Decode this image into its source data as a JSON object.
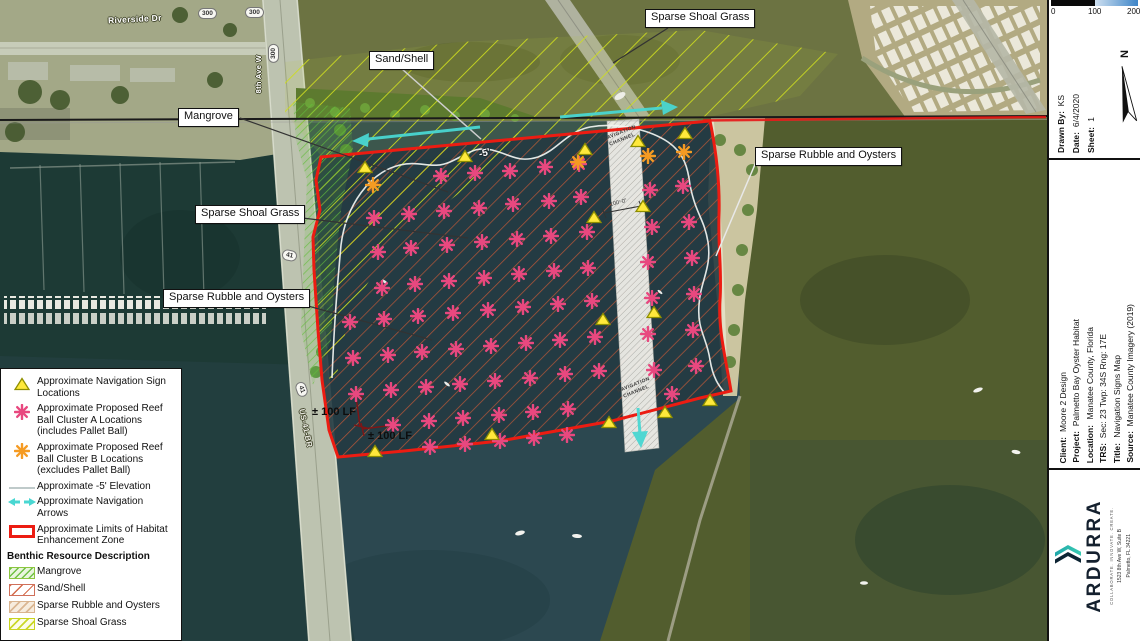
{
  "map": {
    "colors": {
      "zone_outline": "#ec1c12",
      "navigation_arrows": "#49d7d2",
      "cluster_a": "#e8487f",
      "cluster_b": "#f59b23",
      "nav_sign": "#ffe93b"
    },
    "street_labels": {
      "riverside": "Riverside Dr",
      "route300": "300",
      "ave8": "8th Ave W",
      "route41": "41",
      "us41br": "US-41-BR"
    },
    "callouts": {
      "shoal_top": "Sparse Shoal Grass",
      "sand_shell": "Sand/Shell",
      "mangrove": "Mangrove",
      "shoal_left": "Sparse Shoal Grass",
      "rubble_left": "Sparse Rubble and Oysters",
      "rubble_right": "Sparse Rubble and Oysters"
    },
    "channel_label": "NAVIGATION CHANNEL",
    "channel_width_label": "100'-0\"",
    "elevation_label": "-5'",
    "dim_labels": [
      "± 100 LF",
      "± 100 LF"
    ],
    "markers": {
      "cluster_a_color": "#e8487f",
      "cluster_b_color": "#f59b23",
      "sign_color": "#ffe93b",
      "cluster_a": [
        [
          441,
          176
        ],
        [
          475,
          173
        ],
        [
          510,
          171
        ],
        [
          545,
          167
        ],
        [
          579,
          164
        ],
        [
          374,
          218
        ],
        [
          409,
          214
        ],
        [
          444,
          211
        ],
        [
          479,
          208
        ],
        [
          513,
          204
        ],
        [
          549,
          201
        ],
        [
          581,
          197
        ],
        [
          378,
          252
        ],
        [
          411,
          248
        ],
        [
          447,
          245
        ],
        [
          482,
          242
        ],
        [
          517,
          239
        ],
        [
          551,
          236
        ],
        [
          587,
          232
        ],
        [
          382,
          288
        ],
        [
          415,
          284
        ],
        [
          449,
          281
        ],
        [
          484,
          278
        ],
        [
          519,
          274
        ],
        [
          554,
          271
        ],
        [
          588,
          268
        ],
        [
          350,
          322
        ],
        [
          384,
          319
        ],
        [
          418,
          316
        ],
        [
          453,
          313
        ],
        [
          488,
          310
        ],
        [
          523,
          307
        ],
        [
          558,
          304
        ],
        [
          592,
          301
        ],
        [
          353,
          358
        ],
        [
          388,
          355
        ],
        [
          422,
          352
        ],
        [
          456,
          349
        ],
        [
          491,
          346
        ],
        [
          526,
          343
        ],
        [
          560,
          340
        ],
        [
          595,
          337
        ],
        [
          356,
          394
        ],
        [
          391,
          390
        ],
        [
          426,
          387
        ],
        [
          460,
          384
        ],
        [
          495,
          381
        ],
        [
          530,
          378
        ],
        [
          565,
          374
        ],
        [
          599,
          371
        ],
        [
          393,
          425
        ],
        [
          429,
          421
        ],
        [
          463,
          418
        ],
        [
          499,
          415
        ],
        [
          533,
          412
        ],
        [
          568,
          409
        ],
        [
          430,
          447
        ],
        [
          465,
          444
        ],
        [
          500,
          441
        ],
        [
          534,
          438
        ],
        [
          567,
          435
        ],
        [
          650,
          190
        ],
        [
          683,
          186
        ],
        [
          652,
          227
        ],
        [
          689,
          222
        ],
        [
          648,
          262
        ],
        [
          692,
          258
        ],
        [
          652,
          298
        ],
        [
          694,
          294
        ],
        [
          648,
          334
        ],
        [
          693,
          330
        ],
        [
          654,
          370
        ],
        [
          696,
          366
        ],
        [
          672,
          394
        ]
      ],
      "cluster_b": [
        [
          373,
          185
        ],
        [
          578,
          162
        ],
        [
          648,
          156
        ],
        [
          684,
          152
        ]
      ],
      "signs": [
        [
          365,
          168
        ],
        [
          465,
          157
        ],
        [
          585,
          150
        ],
        [
          638,
          142
        ],
        [
          685,
          134
        ],
        [
          594,
          218
        ],
        [
          643,
          207
        ],
        [
          603,
          320
        ],
        [
          654,
          313
        ],
        [
          375,
          452
        ],
        [
          492,
          435
        ],
        [
          609,
          423
        ],
        [
          665,
          413
        ],
        [
          710,
          401
        ]
      ]
    }
  },
  "legend": {
    "items": [
      "Approximate Navigation Sign Locations",
      "Approximate Proposed Reef Ball Cluster A Locations (includes Pallet Ball)",
      "Approximate Proposed Reef Ball Cluster B Locations (excludes Pallet Ball)",
      "Approximate -5' Elevation",
      "Approximate Navigation Arrows",
      "Approximate Limits of Habitat Enhancement Zone"
    ],
    "benthic_header": "Benthic Resource Description",
    "benthic": [
      "Mangrove",
      "Sand/Shell",
      "Sparse Rubble and Oysters",
      "Sparse Shoal Grass"
    ]
  },
  "scalebar": {
    "ticks": [
      "0",
      "100",
      "200"
    ]
  },
  "titleblock": {
    "drawn_by_label": "Drawn By:",
    "drawn_by": "KS",
    "date_label": "Date:",
    "date": "6/4/2020",
    "sheet_label": "Sheet:",
    "sheet": "1",
    "north_label": "N",
    "fields": [
      {
        "label": "Client:",
        "value": "Moore 2 Design"
      },
      {
        "label": "Project:",
        "value": "Palmetto Bay Oyster Habitat"
      },
      {
        "label": "Location:",
        "value": "Manatee County, Florida"
      },
      {
        "label": "TRS:",
        "value": "Sec: 23 Twp: 34S Rng: 17E"
      },
      {
        "label": "Title:",
        "value": "Navigation Signs Map"
      },
      {
        "label": "Source:",
        "value": "Manatee County Imagery (2019)"
      }
    ]
  },
  "logo": {
    "name": "ARDURRA",
    "tagline": "COLLABORATE. INNOVATE. CREATE.",
    "address1": "1523 8th Ave W, Suite B",
    "address2": "Palmetto, FL 34221"
  }
}
